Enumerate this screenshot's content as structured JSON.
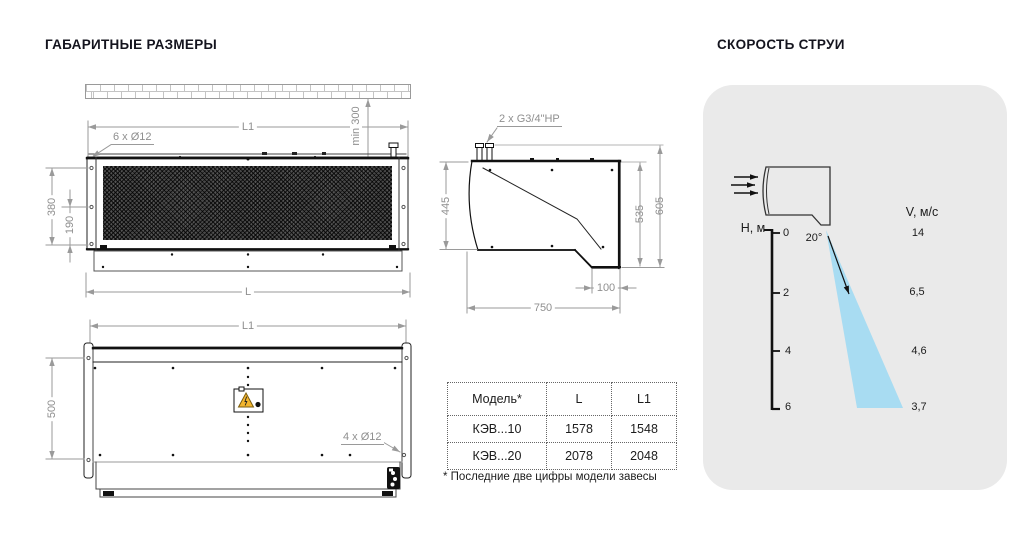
{
  "titles": {
    "left": "ГАБАРИТНЫЕ РАЗМЕРЫ",
    "right": "СКОРОСТЬ СТРУИ"
  },
  "front_view": {
    "l1": "L1",
    "min300": "min 300",
    "holes": "6 x Ø12",
    "d380": "380",
    "d190": "190",
    "l": "L"
  },
  "side_view": {
    "fitting": "2 x G3/4\"НР",
    "d445": "445",
    "d535": "535",
    "d605": "605",
    "d100": "100",
    "d750": "750"
  },
  "bottom_view": {
    "l1": "L1",
    "d500": "500",
    "holes": "4 x Ø12"
  },
  "table": {
    "headers": [
      "Модель*",
      "L",
      "L1"
    ],
    "rows": [
      [
        "КЭВ...10",
        "1578",
        "1548"
      ],
      [
        "КЭВ...20",
        "2078",
        "2048"
      ]
    ],
    "footnote": "* Последние две цифры модели завесы"
  },
  "jet_panel": {
    "h_axis": "Н, м",
    "v_axis": "V, м/с",
    "angle": "20°",
    "ticks": [
      "0",
      "2",
      "4",
      "6"
    ],
    "velocities": [
      "14",
      "6,5",
      "4,6",
      "3,7"
    ]
  },
  "chart_data": {
    "type": "scatter",
    "title": "СКОРОСТЬ СТРУИ",
    "xlabel": "Н, м",
    "ylabel": "V, м/с",
    "x": [
      0,
      2,
      4,
      6
    ],
    "values": [
      14,
      6.5,
      4.6,
      3.7
    ],
    "annotations": [
      "20°",
      "jet spread angle from outlet"
    ]
  },
  "colors": {
    "jet": "#a8dcf2",
    "panel_bg": "#eaeaea",
    "warning": "#f2b52e",
    "dim_gray": "#8f8f8f",
    "line_black": "#1a1a1a"
  }
}
